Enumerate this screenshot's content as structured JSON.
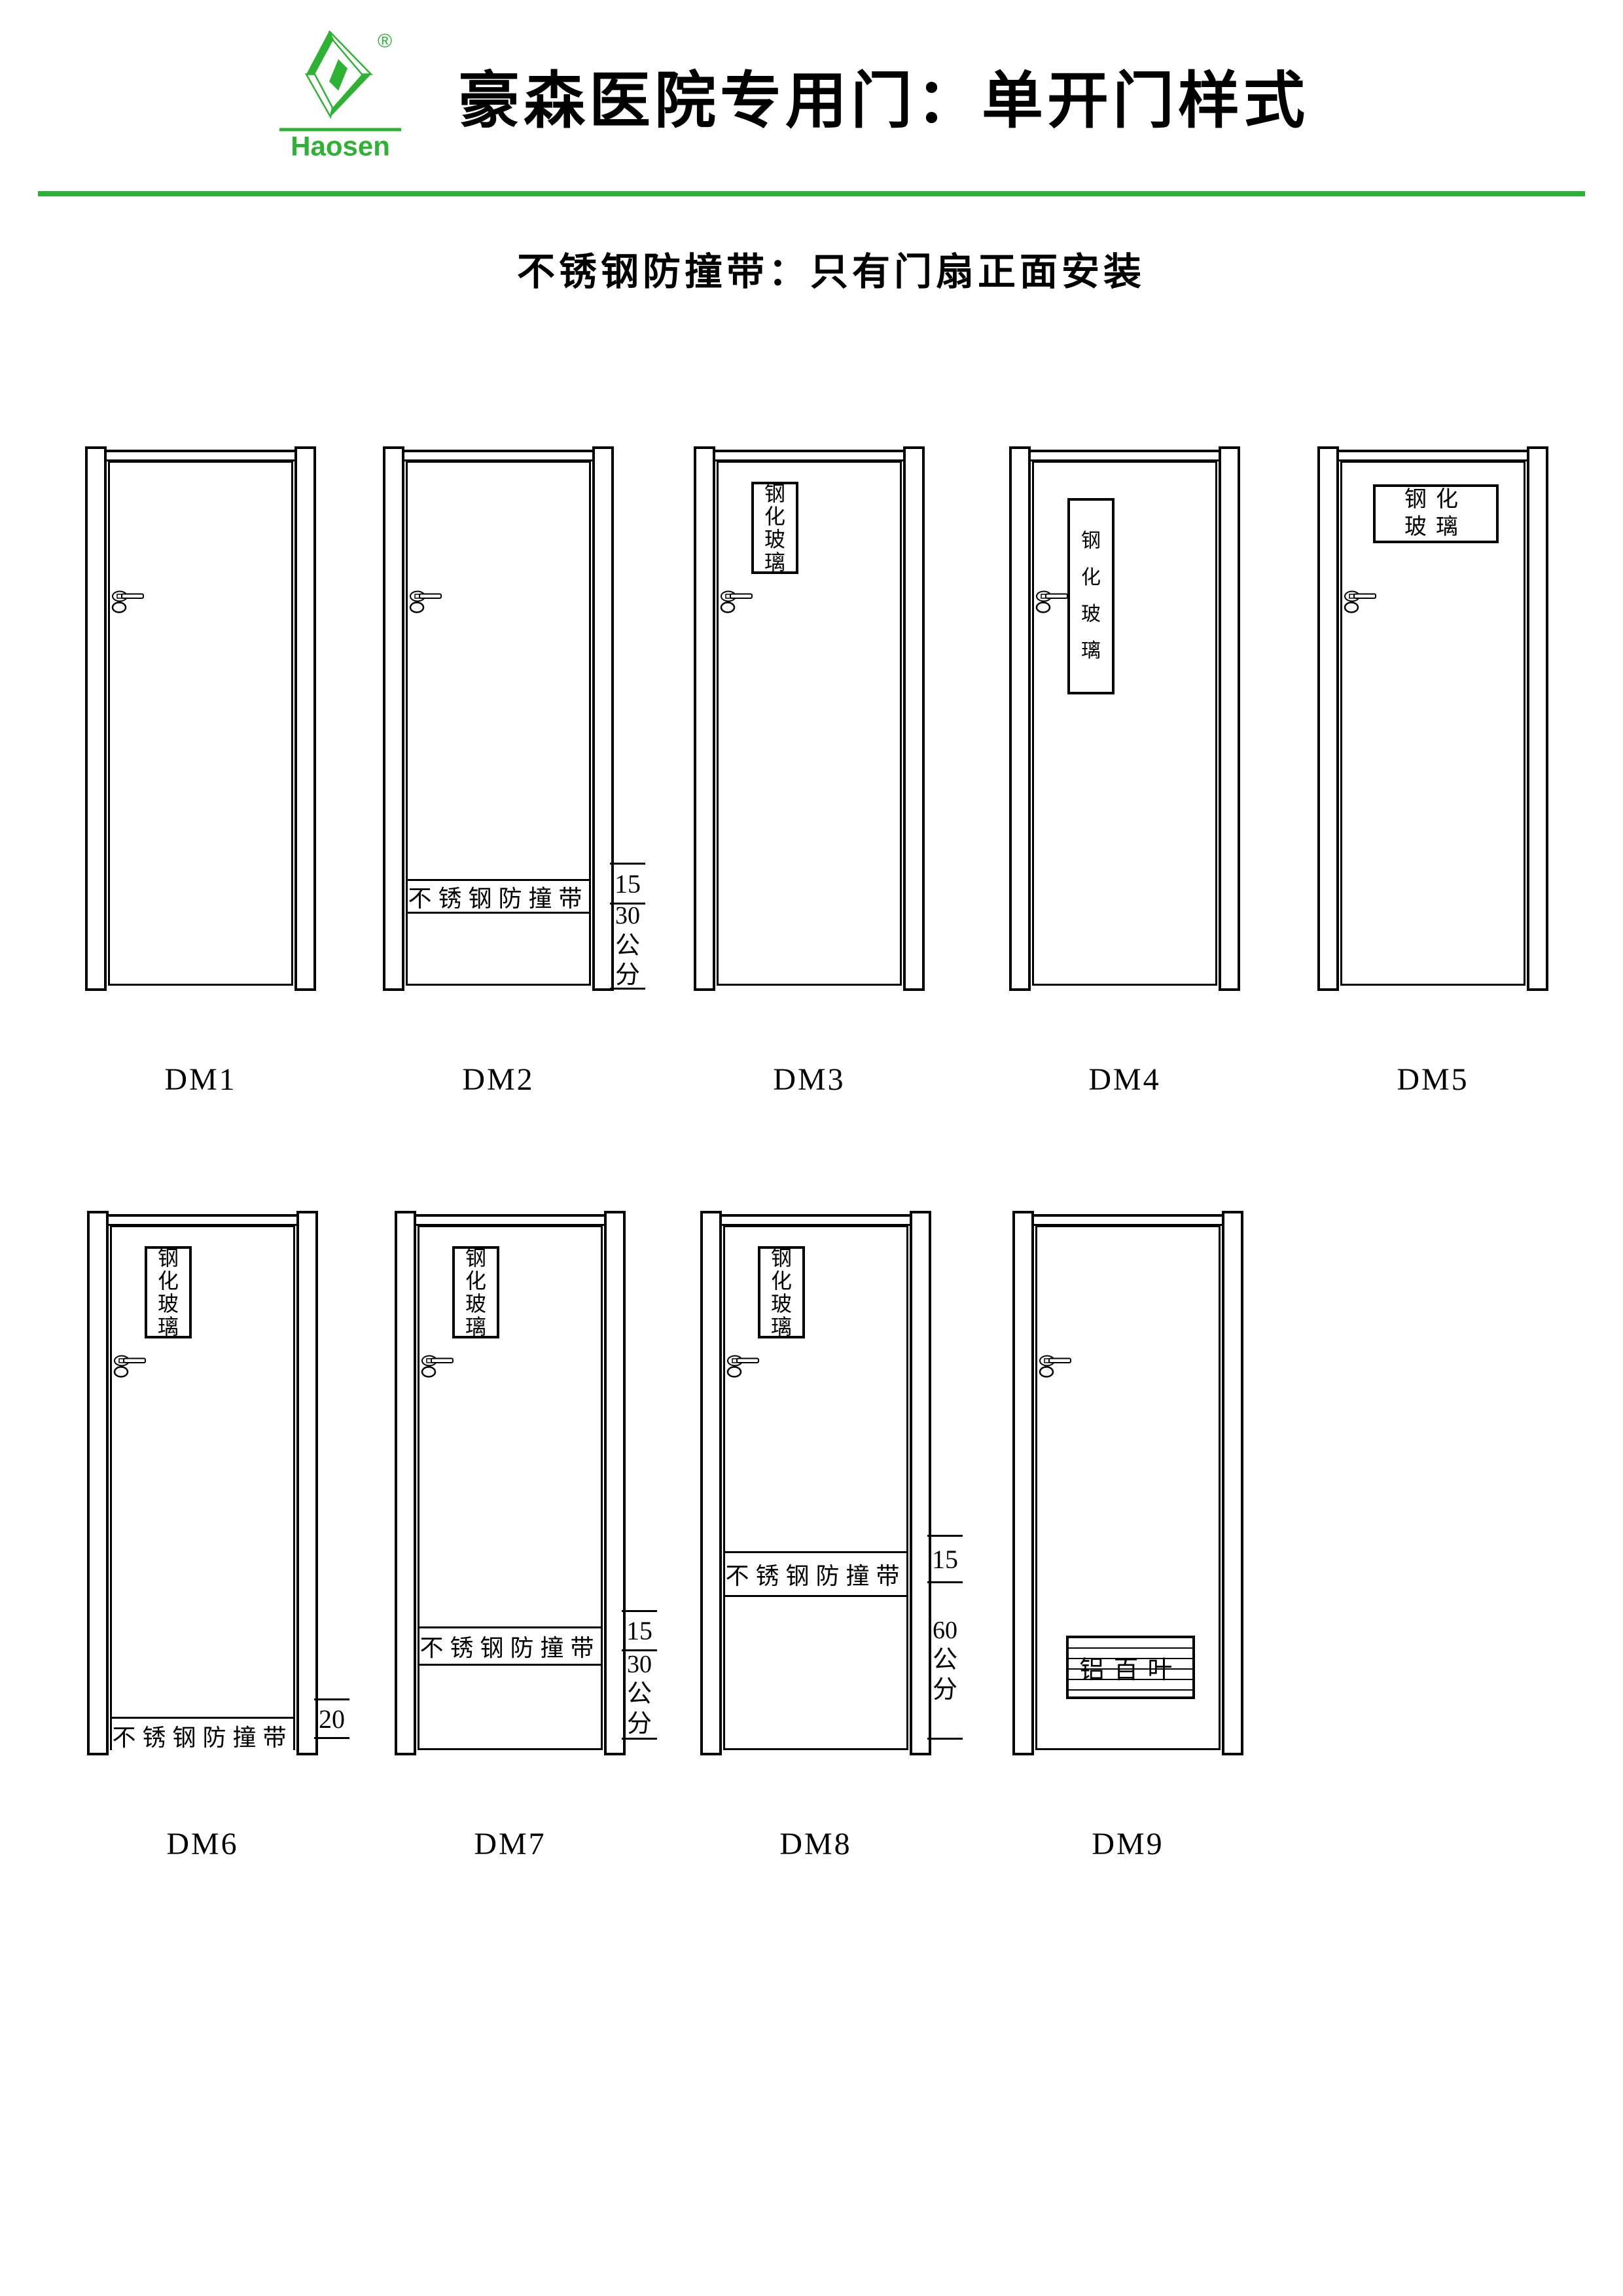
{
  "colors": {
    "brand_green": "#2eb135"
  },
  "logo": {
    "brand": "Haosen",
    "registered_mark": "®"
  },
  "header": {
    "title": "豪森医院专用门：单开门样式",
    "subtitle": "不锈钢防撞带：只有门扇正面安装"
  },
  "doors": [
    {
      "label": "DM1"
    },
    {
      "label": "DM2",
      "strip": "不锈钢防撞带",
      "dim_upper": "15",
      "dim_lower": "30公分"
    },
    {
      "label": "DM3",
      "window": "钢化玻璃"
    },
    {
      "label": "DM4",
      "window": "钢化玻璃"
    },
    {
      "label": "DM5",
      "window": "钢化玻璃"
    },
    {
      "label": "DM6",
      "window": "钢化玻璃",
      "strip": "不锈钢防撞带",
      "dim_upper": "20"
    },
    {
      "label": "DM7",
      "window": "钢化玻璃",
      "strip": "不锈钢防撞带",
      "dim_upper": "15",
      "dim_lower": "30公分"
    },
    {
      "label": "DM8",
      "window": "钢化玻璃",
      "strip": "不锈钢防撞带",
      "dim_upper": "15",
      "dim_lower": "60公分"
    },
    {
      "label": "DM9",
      "louver": "铝百叶"
    }
  ]
}
